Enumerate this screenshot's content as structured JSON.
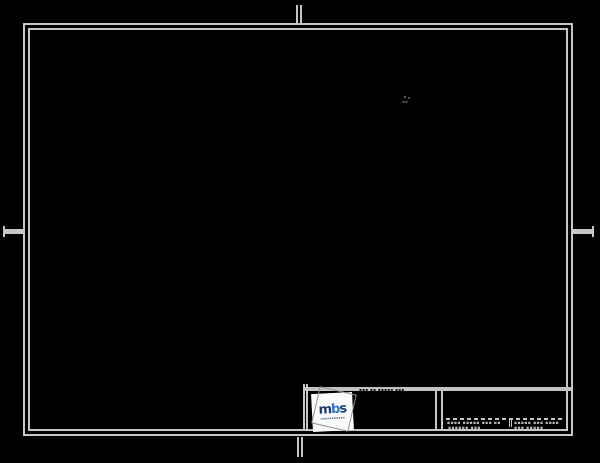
{
  "meta": {
    "colors": {
      "bg": "#000000",
      "frame": "#c6c6c6",
      "bar": "#c2c2c2",
      "ghost": "#8f8f8f",
      "card": "#fafafa",
      "navy": "#1d3e73",
      "blue": "#2f74c9",
      "subtext": "#6b7f99",
      "microLight": "#b8b8b8",
      "microDark": "#161616",
      "mark": "#4f4f4f"
    }
  },
  "sheet": {
    "type": "blank-engineering-drawing-sheet",
    "background": "black",
    "frame": "double-line gray border with fold marks top/bottom/left/right"
  },
  "title_block": {
    "header_micro": "▪▪▪ ▪▪ ▪▪▪▪▪ ▪▪▪",
    "logo": {
      "m": "m",
      "b": "b",
      "s": "s",
      "subtext": "▪▪▪▪▪▪▪▪▪▪▪"
    },
    "info_box": {
      "row1_left": "▪▪▪▪ ▪▪▪▪▪ ▪▪▪ ▪▪",
      "row1_right": "▪▪▪▪▪ ▪▪▪ ▪▪▪▪",
      "row2_left": "▪▪▪▪▪▪ ▪▪▪",
      "row2_right": "▪▪▪ ▪▪▪▪▪"
    }
  }
}
